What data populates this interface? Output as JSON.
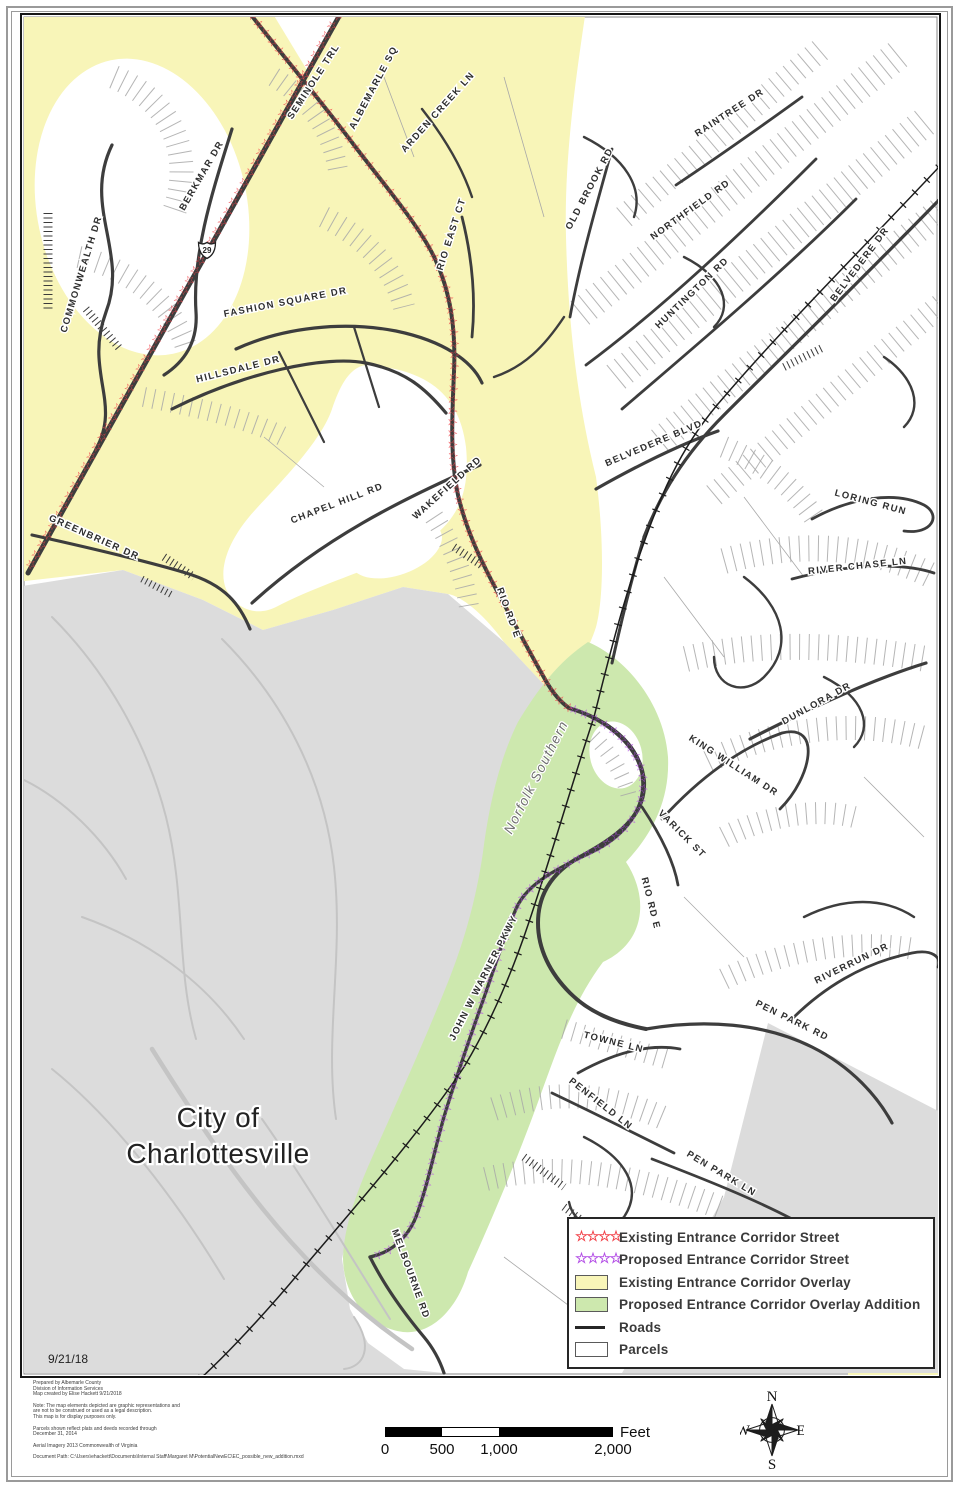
{
  "page": {
    "date": "9/21/18"
  },
  "map": {
    "city_label_line1": "City of",
    "city_label_line2": "Charlottesville",
    "railroad_label": "Norfolk Southern",
    "route_shield": "29",
    "streets": {
      "commonwealth": "COMMONWEALTH DR",
      "berkmar": "BERKMAR DR",
      "seminole": "SEMINOLE TRL",
      "albemarle_sq": "ALBEMARLE SQ",
      "arden_creek": "ARDEN CREEK LN",
      "rio_east": "RIO EAST CT",
      "old_brook": "OLD BROOK RD",
      "raintree": "RAINTREE DR",
      "northfield": "NORTHFIELD RD",
      "huntington": "HUNTINGTON RD",
      "belvedere_dr": "BELVEDERE DR",
      "fashion_square": "FASHION SQUARE DR",
      "hillsdale": "HILLSDALE DR",
      "chapel_hill": "CHAPEL HILL RD",
      "wakefield": "WAKEFIELD RD",
      "greenbrier": "GREENBRIER DR",
      "rio_rd_n": "RIO RD E",
      "belvedere_blvd": "BELVEDERE BLVD",
      "loring_run": "LORING RUN",
      "river_chase": "RIVER CHASE LN",
      "dunlora": "DUNLORA DR",
      "king_william": "KING WILLIAM DR",
      "varick": "VARICK ST",
      "rio_rd_s": "RIO RD E",
      "riverrun": "RIVERRUN DR",
      "pen_park_rd": "PEN PARK RD",
      "towne": "TOWNE LN",
      "penfield": "PENFIELD LN",
      "pen_park_ln": "PEN PARK LN",
      "warner": "JOHN W WARNER PKWY",
      "melbourne": "MELBOURNE RD"
    },
    "star_chains": {
      "existing_29": "☆☆☆☆☆☆☆☆☆☆☆☆☆☆☆☆☆☆☆☆☆☆☆☆☆☆☆☆☆☆☆☆☆☆☆☆☆☆☆☆☆☆☆☆☆☆☆☆☆☆☆☆☆☆☆☆☆☆☆☆",
      "existing_rio": "☆☆☆☆☆☆☆☆☆☆☆☆☆☆☆☆☆☆☆☆☆☆☆☆☆☆☆☆☆☆☆☆☆☆☆☆☆☆☆☆☆☆☆☆☆☆☆☆☆☆☆☆☆☆☆☆☆☆☆☆☆☆☆☆☆☆☆☆☆☆☆☆☆☆☆",
      "proposed": "☆☆☆☆☆☆☆☆☆☆☆☆☆☆☆☆☆☆☆☆☆☆☆☆☆☆☆☆☆☆☆☆☆☆☆☆☆☆☆☆☆☆☆☆☆☆☆☆☆☆☆☆☆☆☆☆☆☆☆☆☆☆☆☆☆☆☆☆☆☆"
    }
  },
  "legend": {
    "items": [
      {
        "symbol": "stars",
        "stars": "☆☆☆☆",
        "color": "#F2444B",
        "label": "Existing Entrance Corridor Street"
      },
      {
        "symbol": "stars",
        "stars": "☆☆☆☆",
        "color": "#B450E6",
        "label": "Proposed Entrance Corridor Street"
      },
      {
        "symbol": "swatch",
        "color": "#F8F5B8",
        "label": "Existing Entrance Corridor Overlay"
      },
      {
        "symbol": "swatch",
        "color": "#CDE8AE",
        "label": "Proposed Entrance Corridor Overlay Addition"
      },
      {
        "symbol": "line",
        "color": "#262626",
        "label": "Roads"
      },
      {
        "symbol": "swatch",
        "color": "#FFFFFF",
        "label": "Parcels"
      }
    ]
  },
  "scalebar": {
    "ticks": [
      "0",
      "500",
      "1,000",
      "2,000"
    ],
    "unit": "Feet"
  },
  "compass": {
    "n": "N",
    "e": "E",
    "s": "S",
    "w": "W"
  },
  "notes": {
    "p1": "Prepared by Albemarle County\nDivision of Information Services\nMap created by Elise Hackett 9/21/2018",
    "p2": "Note: The map elements depicted are graphic representations and\nare not to be construed or used as a legal description.\nThis map is for display purposes only.",
    "p3": "Parcels shown reflect plats and deeds recorded through\nDecember 31, 2014",
    "p4": "Aerial Imagery 2013 Commonwealth of Virginia",
    "p5": "Document Path: C:\\Users\\ehackett\\Documents\\Internal Staff\\Margaret M\\PotentialNewEC\\EC_possible_new_addition.mxd"
  },
  "colors": {
    "existing_overlay_yellow": "#F8F5B8",
    "proposed_overlay_green": "#CDE8AE",
    "city_gray": "#DCDCDC",
    "road_dark": "#3D3D3D",
    "parcel_line_gray": "#A8A8A8",
    "existing_star_red": "#F2444B",
    "proposed_star_purple": "#B450E6"
  }
}
